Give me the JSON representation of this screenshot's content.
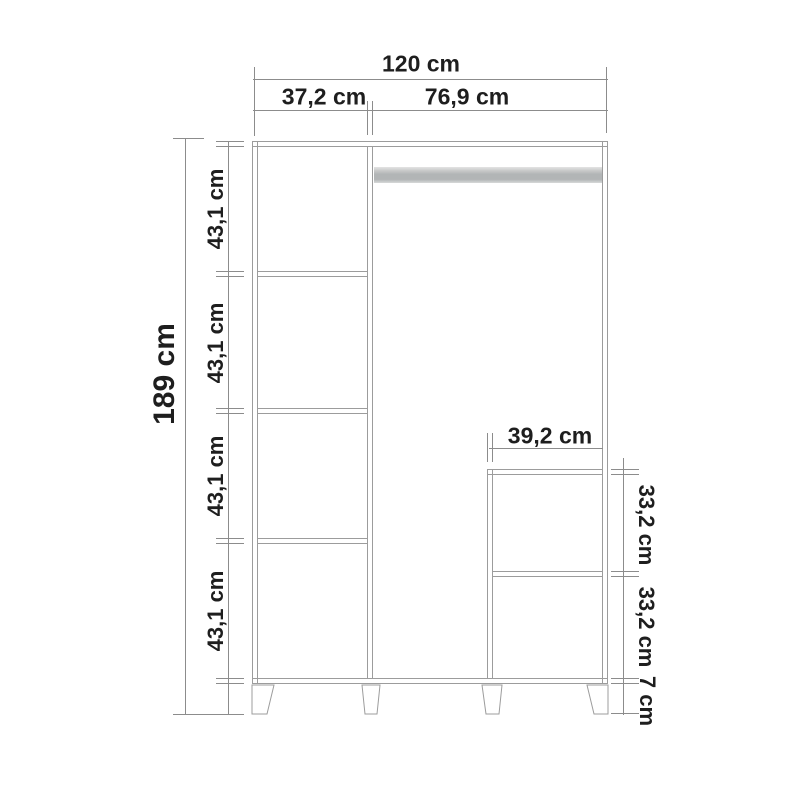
{
  "units": "cm",
  "colors": {
    "line": "#9c9c9c",
    "dim": "#8c8c8c",
    "text": "#1e1e1e",
    "bg": "#ffffff",
    "rail": "#b2b5b6"
  },
  "dimensions": {
    "overall_width": {
      "label": "120 cm",
      "value": 120
    },
    "left_column_width": {
      "label": "37,2 cm",
      "value": 37.2
    },
    "right_section_width": {
      "label": "76,9 cm",
      "value": 76.9
    },
    "overall_height": {
      "label": "189 cm",
      "value": 189
    },
    "left_shelf_heights": [
      {
        "label": "43,1 cm",
        "value": 43.1
      },
      {
        "label": "43,1 cm",
        "value": 43.1
      },
      {
        "label": "43,1 cm",
        "value": 43.1
      },
      {
        "label": "43,1 cm",
        "value": 43.1
      }
    ],
    "inner_unit_width": {
      "label": "39,2 cm",
      "value": 39.2
    },
    "inner_unit_heights": [
      {
        "label": "33,2 cm",
        "value": 33.2
      },
      {
        "label": "33,2 cm",
        "value": 33.2
      }
    ],
    "leg_height": {
      "label": "7 cm",
      "value": 7
    }
  }
}
